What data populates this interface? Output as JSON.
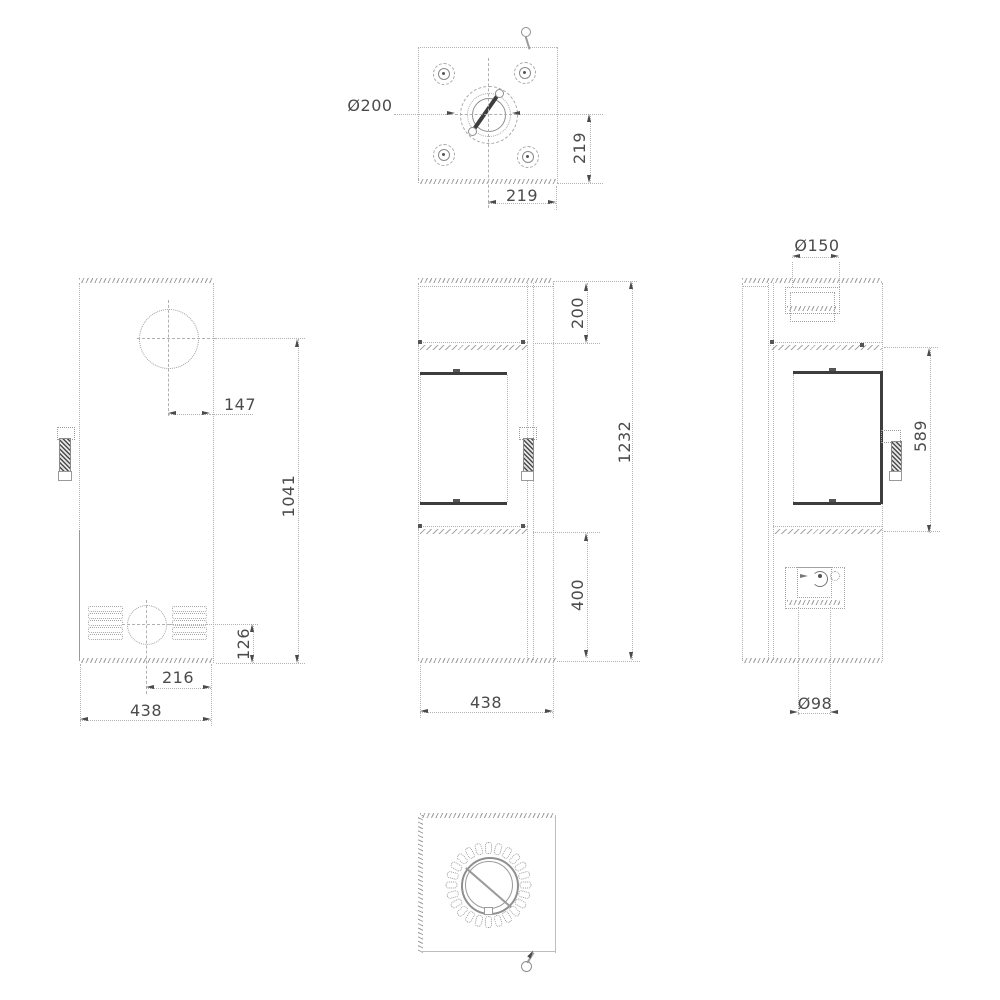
{
  "title": "Free-standing stove technical drawing, five orthographic views",
  "colors": {
    "line": "#b2b2b2",
    "dark": "#3d3d3d",
    "text": "#4b4b4b"
  },
  "views": {
    "top": {
      "label": "top-view",
      "flue_diameter": "Ø200",
      "flue_to_back": "219",
      "flue_to_side": "219",
      "bolt_count": 4
    },
    "left": {
      "label": "left-side-view",
      "flue_center_offset": "147",
      "flue_center_height": "1041",
      "intake_center_height": "126",
      "intake_center_offset": "216",
      "depth": "438",
      "vent_rows": 5
    },
    "front": {
      "label": "front-view",
      "top_section_height": "200",
      "total_height": "1232",
      "base_section_height": "400",
      "width": "438"
    },
    "right": {
      "label": "right-side-view",
      "collar_diameter": "Ø150",
      "door_glass_height": "589",
      "intake_diameter": "Ø98"
    },
    "bottom": {
      "label": "bottom-view",
      "knob_slot_count": 24
    }
  }
}
